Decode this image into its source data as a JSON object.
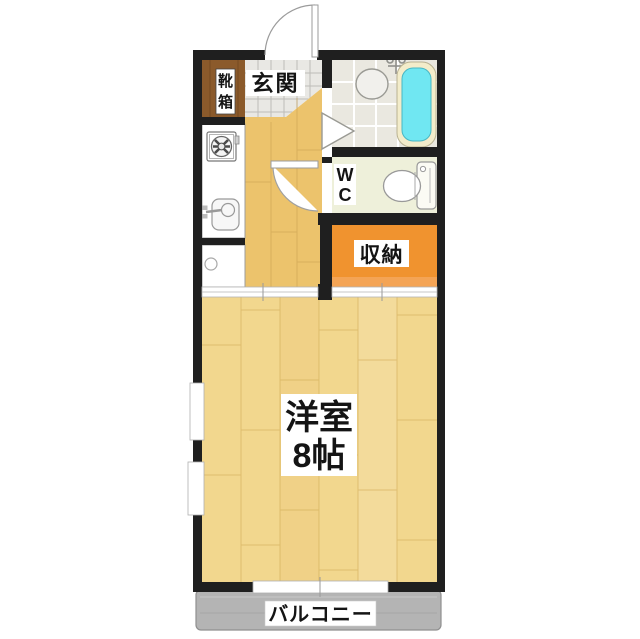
{
  "plan_type": "apartment-floor-plan",
  "labels": {
    "entrance": "玄関",
    "shoe_cabinet": {
      "full": "靴箱",
      "lines": [
        "靴",
        "箱"
      ]
    },
    "wc": {
      "full": "WC",
      "lines": [
        "W",
        "C"
      ]
    },
    "storage": "収納",
    "main_room": {
      "full": "洋室 8帖",
      "lines": [
        "洋室",
        "8帖"
      ]
    },
    "balcony": "バルコニー"
  },
  "colors": {
    "wall": "#1f1f1f",
    "entrance_tile": "#e9e8e4",
    "bath_tile": "#eae8e0",
    "bathtub_water": "#70e7f2",
    "bathtub_rim": "#f3ecca",
    "wc_floor": "#eef0da",
    "storage": "#f0932f",
    "storage_light_edge": "#f5a75c",
    "shoe_cabinet": "#8b5a2b",
    "hallway_wood": "#ecc36c",
    "room_wood": "#f2d78e",
    "balcony": "#b4b4b4"
  }
}
